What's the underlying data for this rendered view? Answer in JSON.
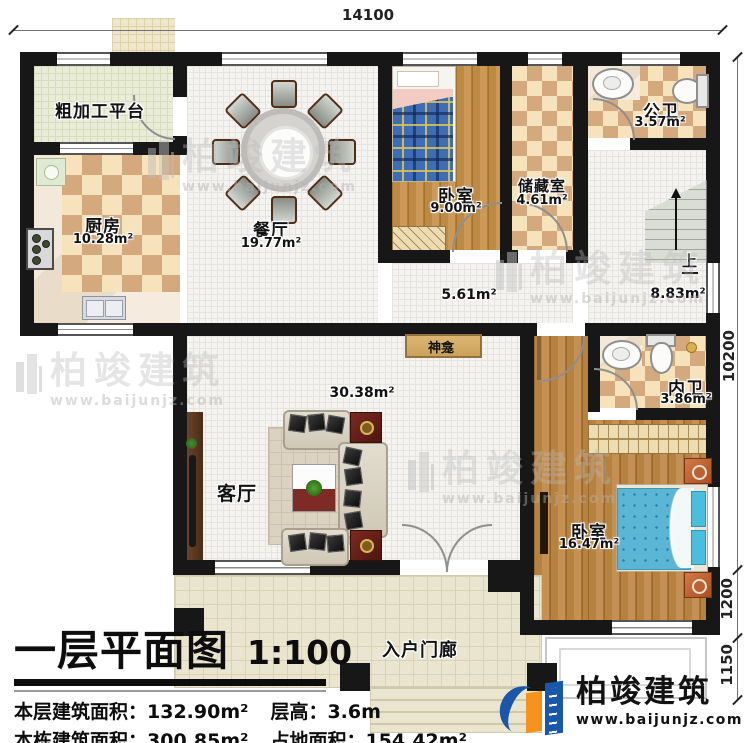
{
  "dimensions": {
    "top": "14100",
    "right_total": "10200",
    "right_seg1": "1200",
    "right_seg2": "1150"
  },
  "rooms": {
    "platform": {
      "name": "粗加工平台"
    },
    "kitchen": {
      "name": "厨房",
      "area": "10.28m²"
    },
    "dining": {
      "name": "餐厅",
      "area": "19.77m²"
    },
    "bedroom_top": {
      "name": "卧室",
      "area": "9.00m²"
    },
    "storage": {
      "name": "储藏室",
      "area": "4.61m²"
    },
    "public_bath": {
      "name": "公卫",
      "area": "3.57m²"
    },
    "stair_hall": {
      "area": "8.83m²",
      "up": "上"
    },
    "hallway": {
      "area": "5.61m²"
    },
    "shrine": {
      "name": "神龛"
    },
    "living": {
      "name": "客厅",
      "area": "30.38m²"
    },
    "inner_bath": {
      "name": "内卫",
      "area": "3.86m²"
    },
    "bedroom_main": {
      "name": "卧室",
      "area": "16.47m²"
    },
    "porch": {
      "name": "入户门廊"
    }
  },
  "title_block": {
    "title": "一层平面图",
    "scale": "1:100",
    "line1_left": "本层建筑面积：132.90m²",
    "line1_right": "层高：3.6m",
    "line2_left": "本栋建筑面积：300.85m²",
    "line2_right": "占地面积：154.42m²"
  },
  "branding": {
    "company": "柏竣建筑",
    "website": "www.baijunjz.com",
    "logo_blue": "#1b57a8",
    "logo_orange": "#f6921e"
  },
  "palette": {
    "wall": "#171717",
    "checker_light": "#f6e3bc",
    "checker_dark": "#d4a97d",
    "watermark_grey": "#bababa"
  }
}
